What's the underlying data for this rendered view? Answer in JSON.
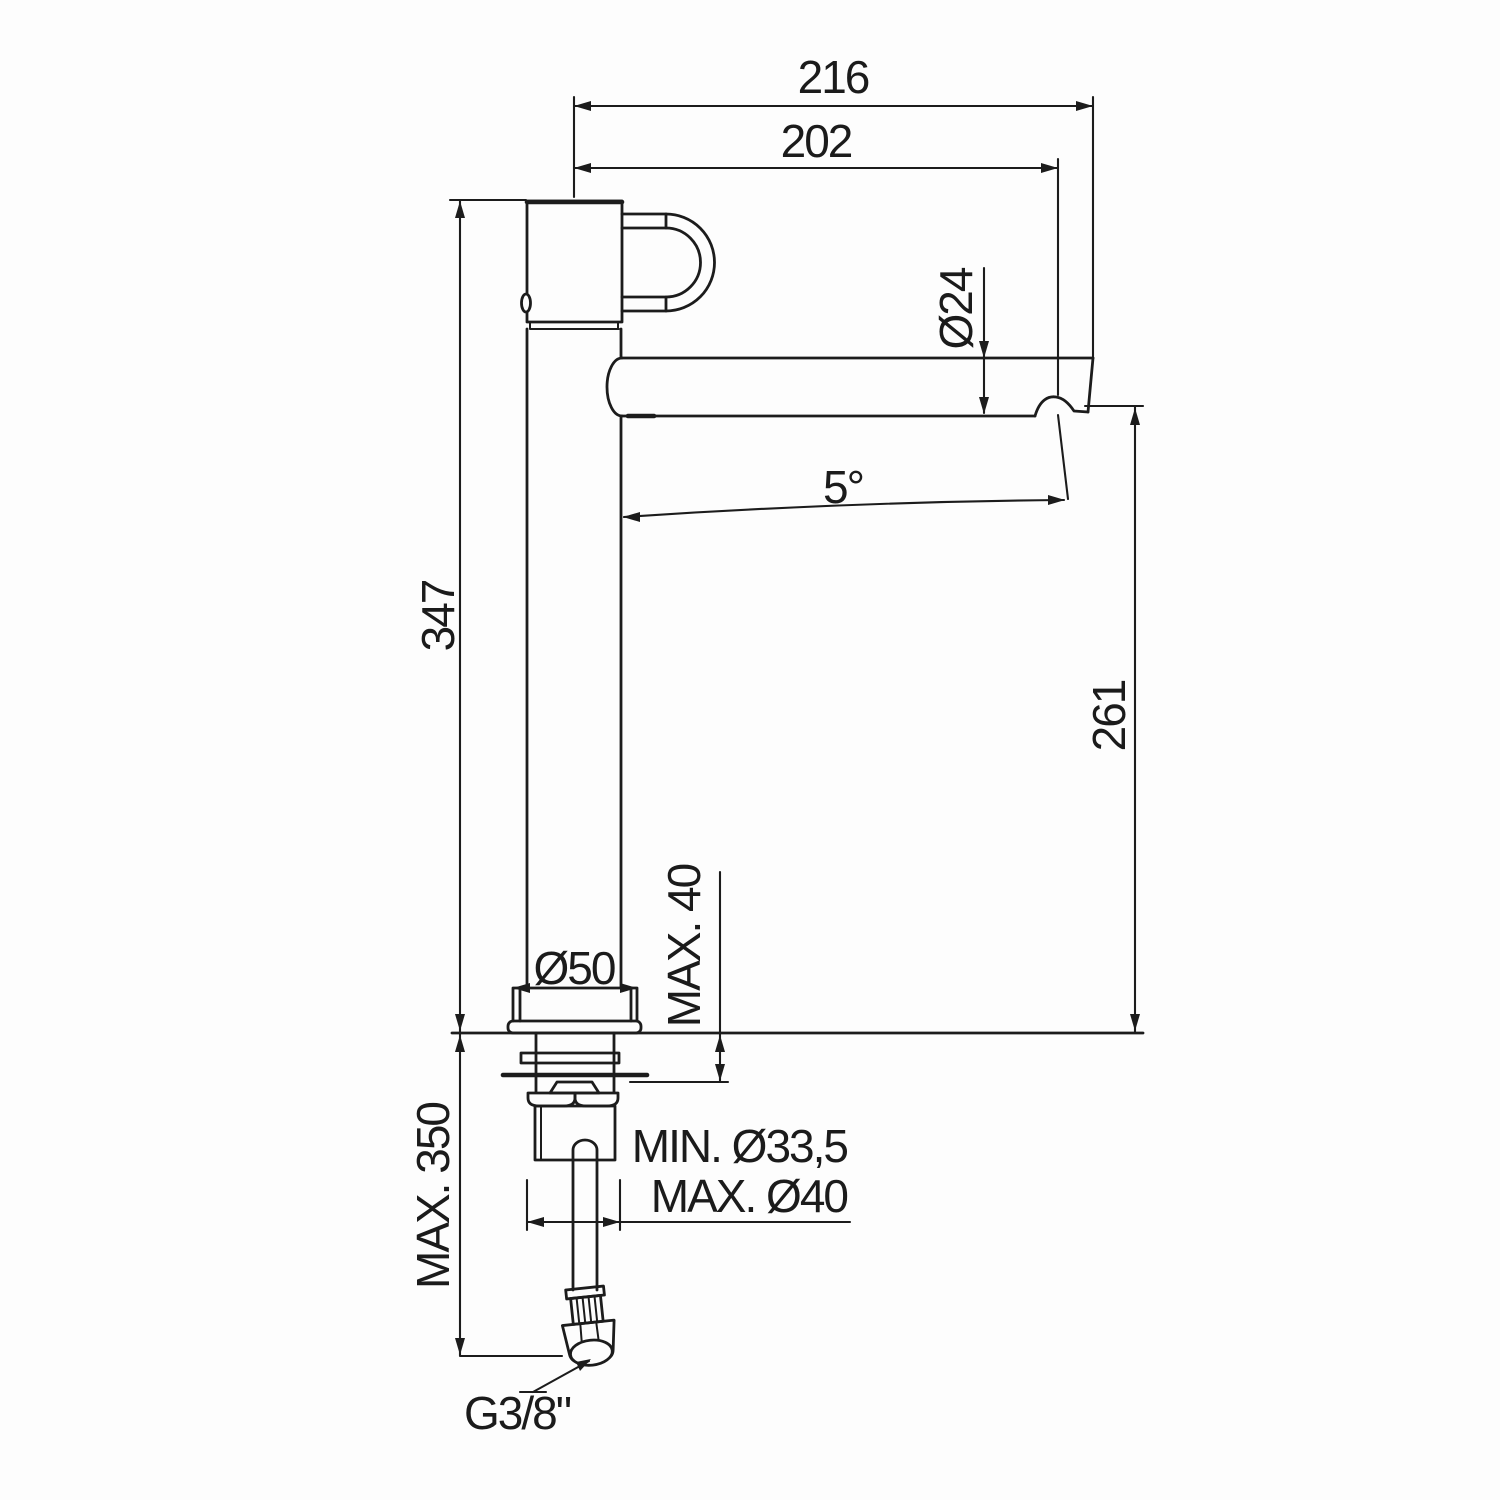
{
  "drawing": {
    "kind": "technical dimension drawing",
    "colors": {
      "line": "#1c1c1c",
      "background": "#fdfdfd"
    },
    "labels": {
      "overall_reach": "216",
      "spout_reach": "202",
      "spout_diameter": "Ø24",
      "spout_inclination": "5°",
      "total_height": "347",
      "spout_height": "261",
      "base_diameter": "Ø50",
      "max_deck_thickness": "MAX. 40",
      "min_hole_diameter": "MIN. Ø33,5",
      "max_hole_diameter": "MAX. Ø40",
      "max_hose_length": "MAX. 350",
      "supply_connection": "G3/8\""
    }
  }
}
